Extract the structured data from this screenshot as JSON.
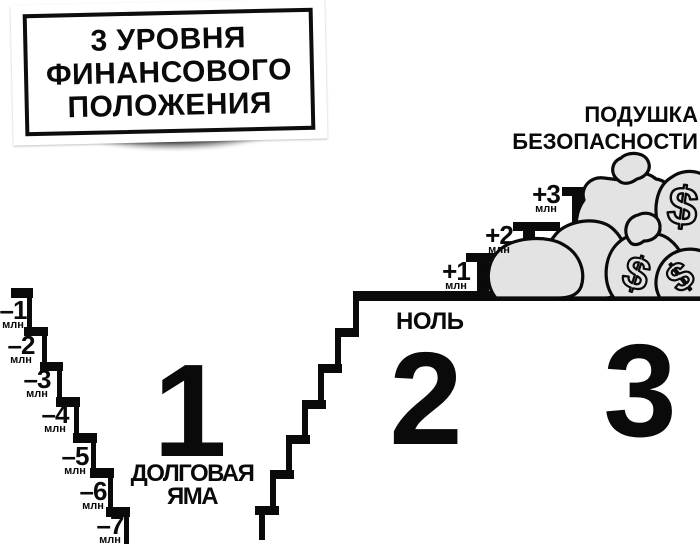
{
  "colors": {
    "ink": "#0a0a0a",
    "paper": "#ffffff",
    "bag_fill": "#e3e3e3",
    "card_shadow": "#3f3f3f"
  },
  "title_card": {
    "lines": [
      "3 УРОВНЯ",
      "ФИНАНСОВОГО",
      "ПОЛОЖЕНИЯ"
    ]
  },
  "cushion": {
    "lines": [
      "ПОДУШКА",
      "БЕЗОПАСНОСТИ"
    ]
  },
  "zero_label": "НОЛЬ",
  "levels": {
    "one": {
      "number": "1",
      "caption_lines": [
        "ДОЛГОВАЯ",
        "ЯМА"
      ]
    },
    "two": {
      "number": "2"
    },
    "three": {
      "number": "3"
    }
  },
  "debt_steps": [
    {
      "value": "–1",
      "unit": "млн"
    },
    {
      "value": "–2",
      "unit": "млн"
    },
    {
      "value": "–3",
      "unit": "млн"
    },
    {
      "value": "–4",
      "unit": "млн"
    },
    {
      "value": "–5",
      "unit": "млн"
    },
    {
      "value": "–6",
      "unit": "млн"
    },
    {
      "value": "–7",
      "unit": "млн"
    }
  ],
  "gain_steps": [
    {
      "value": "+1",
      "unit": "млн"
    },
    {
      "value": "+2",
      "unit": "млн"
    },
    {
      "value": "+3",
      "unit": "млн"
    }
  ],
  "money_bags": {
    "currency": "$",
    "count": 6
  }
}
